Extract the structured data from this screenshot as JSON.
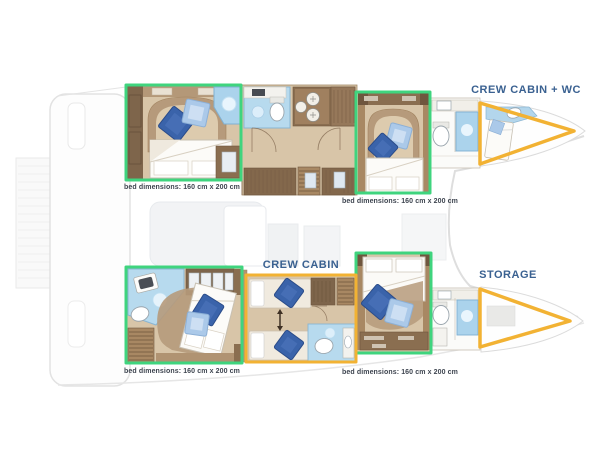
{
  "plan": {
    "type": "catamaran cabin layout plan",
    "zones": {
      "crew_cabin_wc": "CREW CABIN + WC",
      "crew_cabin": "CREW CABIN",
      "storage": "STORAGE"
    },
    "bed_notes": [
      "bed dimensions: 160 cm x 200 cm",
      "bed dimensions: 160 cm x 200 cm",
      "bed dimensions: 160 cm x 200 cm",
      "bed dimensions: 160 cm x 200 cm"
    ],
    "colors": {
      "cabin_highlight_green": "#3fd47e",
      "crew_highlight_yellow": "#f2b233",
      "zone_label_blue": "#3a6191",
      "note_text": "#3e4550",
      "floor_tan": "#d8c5a8",
      "furniture_brown": "#7e654b",
      "bathroom_blue": "#b7daee",
      "pillow_dark_blue": "#3a63aa",
      "pillow_light_blue": "#abc9e9"
    }
  }
}
